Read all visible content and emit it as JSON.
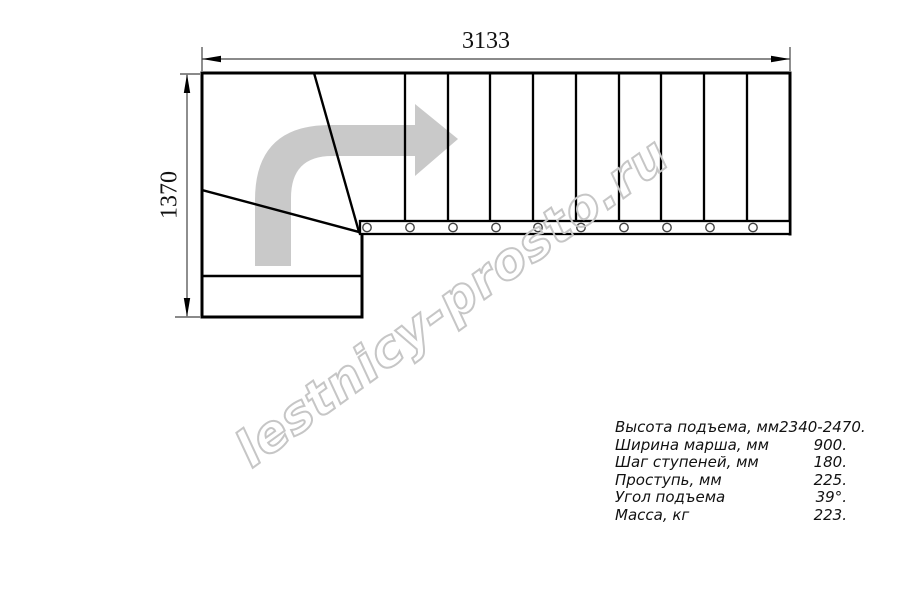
{
  "drawing": {
    "watermark": "lestnicy-prosto.ru",
    "dimensions": {
      "width_label": "3133",
      "height_label": "1370"
    },
    "colors": {
      "line": "#000000",
      "dimension_line": "#444444",
      "direction_arrow": "#c9c9c9",
      "watermark_outline": "#c6c6c6"
    }
  },
  "specs": {
    "rows": [
      {
        "label": "Высота подъема, мм",
        "value": "2340-2470."
      },
      {
        "label": "Ширина марша, мм",
        "value": "900."
      },
      {
        "label": "Шаг ступеней, мм",
        "value": "180."
      },
      {
        "label": "Проступь, мм",
        "value": "225."
      },
      {
        "label": "Угол подъема",
        "value": "39°."
      },
      {
        "label": "Масса, кг",
        "value": "223."
      }
    ]
  }
}
